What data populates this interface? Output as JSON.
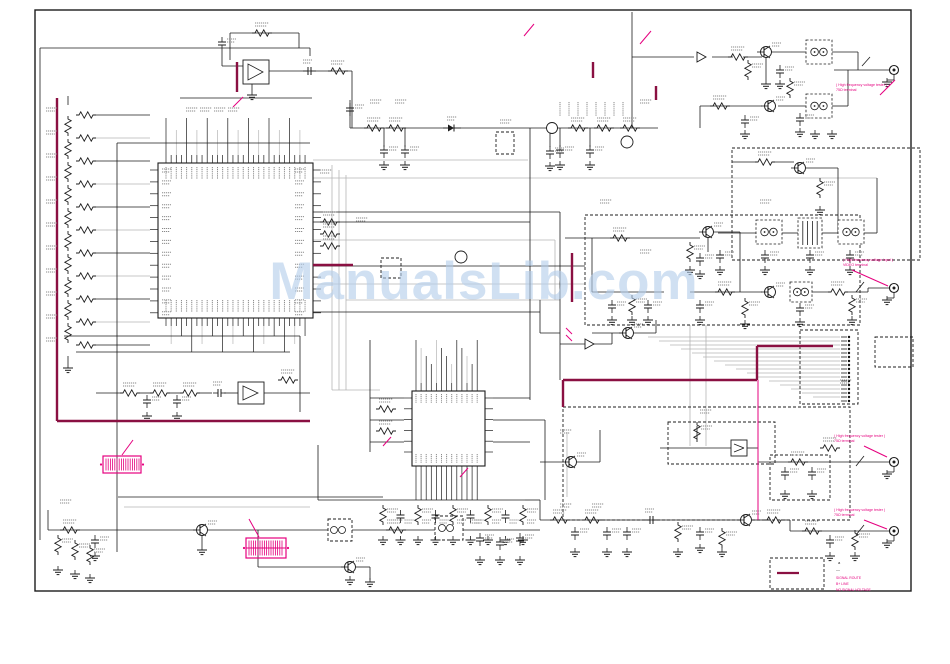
{
  "watermark": {
    "text": "ManualsLib.com",
    "color": "#b3cdea"
  },
  "annotations": {
    "terminal1": {
      "line1": "( High frequency voltage tester )",
      "line2": "75Ω terminal"
    },
    "terminal2": {
      "line1": "( High frequency voltage input )",
      "line2": "VIDEO terminal"
    },
    "terminal3": {
      "line1": "( High frequency voltage tester )",
      "line2": "75Ω terminal"
    },
    "terminal4": {
      "line1": "( High frequency voltage tester )",
      "line2": "75Ω terminal"
    }
  },
  "legend": {
    "marker1": "a",
    "marker2": "—",
    "note1": "SIGNAL ROUTE",
    "note2": "B+ LINE",
    "note3": "NO SIGNAL VOLTAGE",
    "sample_color": "#8a1042"
  },
  "colors": {
    "paper": "#ffffff",
    "wire_black": "#1c1c1c",
    "wire_gray": "#b5b5b5",
    "maroon_trace": "#8a1042",
    "magenta": "#e5007f",
    "micro_label": "#8a8a8a",
    "watermark": "#b3cdea"
  }
}
